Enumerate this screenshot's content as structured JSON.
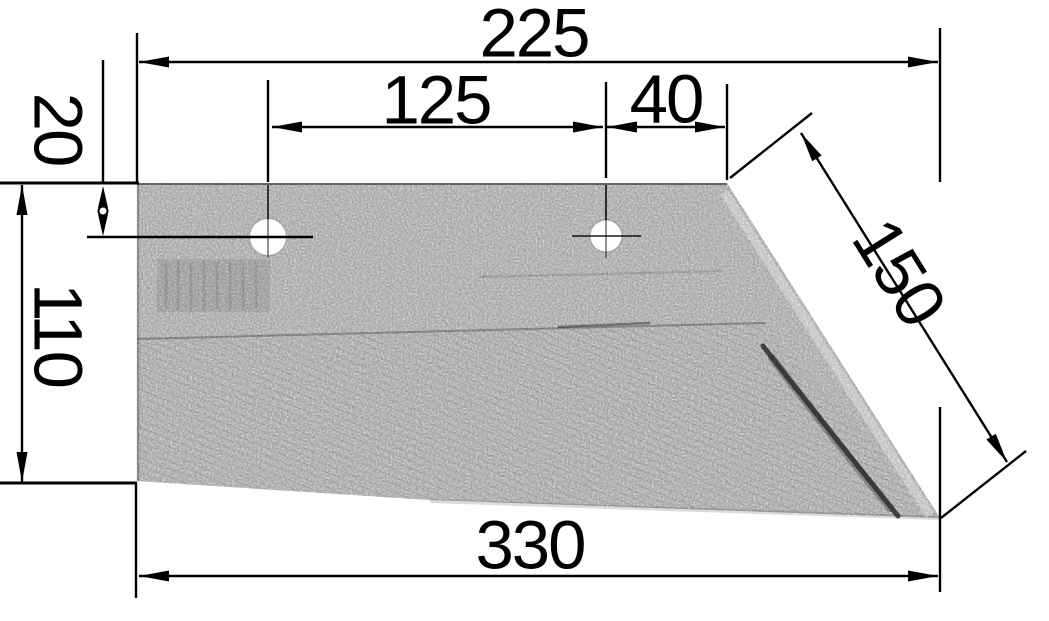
{
  "drawing": {
    "type": "technical-dimension-drawing",
    "colors": {
      "background": "#ffffff",
      "annotation_line": "#000000",
      "plate_base_gray": "#9f9f9f",
      "plate_dark_detail": "#3f3f3f",
      "hole_fill": "#fdfdfd"
    },
    "dimensions": {
      "overall_top_width": "225",
      "hole_spacing": "125",
      "hole_to_top_right_corner": "40",
      "top_edge_to_hole_center": "20",
      "left_edge_height": "110",
      "diagonal_cutting_edge_length": "150",
      "overall_bottom_width": "330"
    }
  }
}
